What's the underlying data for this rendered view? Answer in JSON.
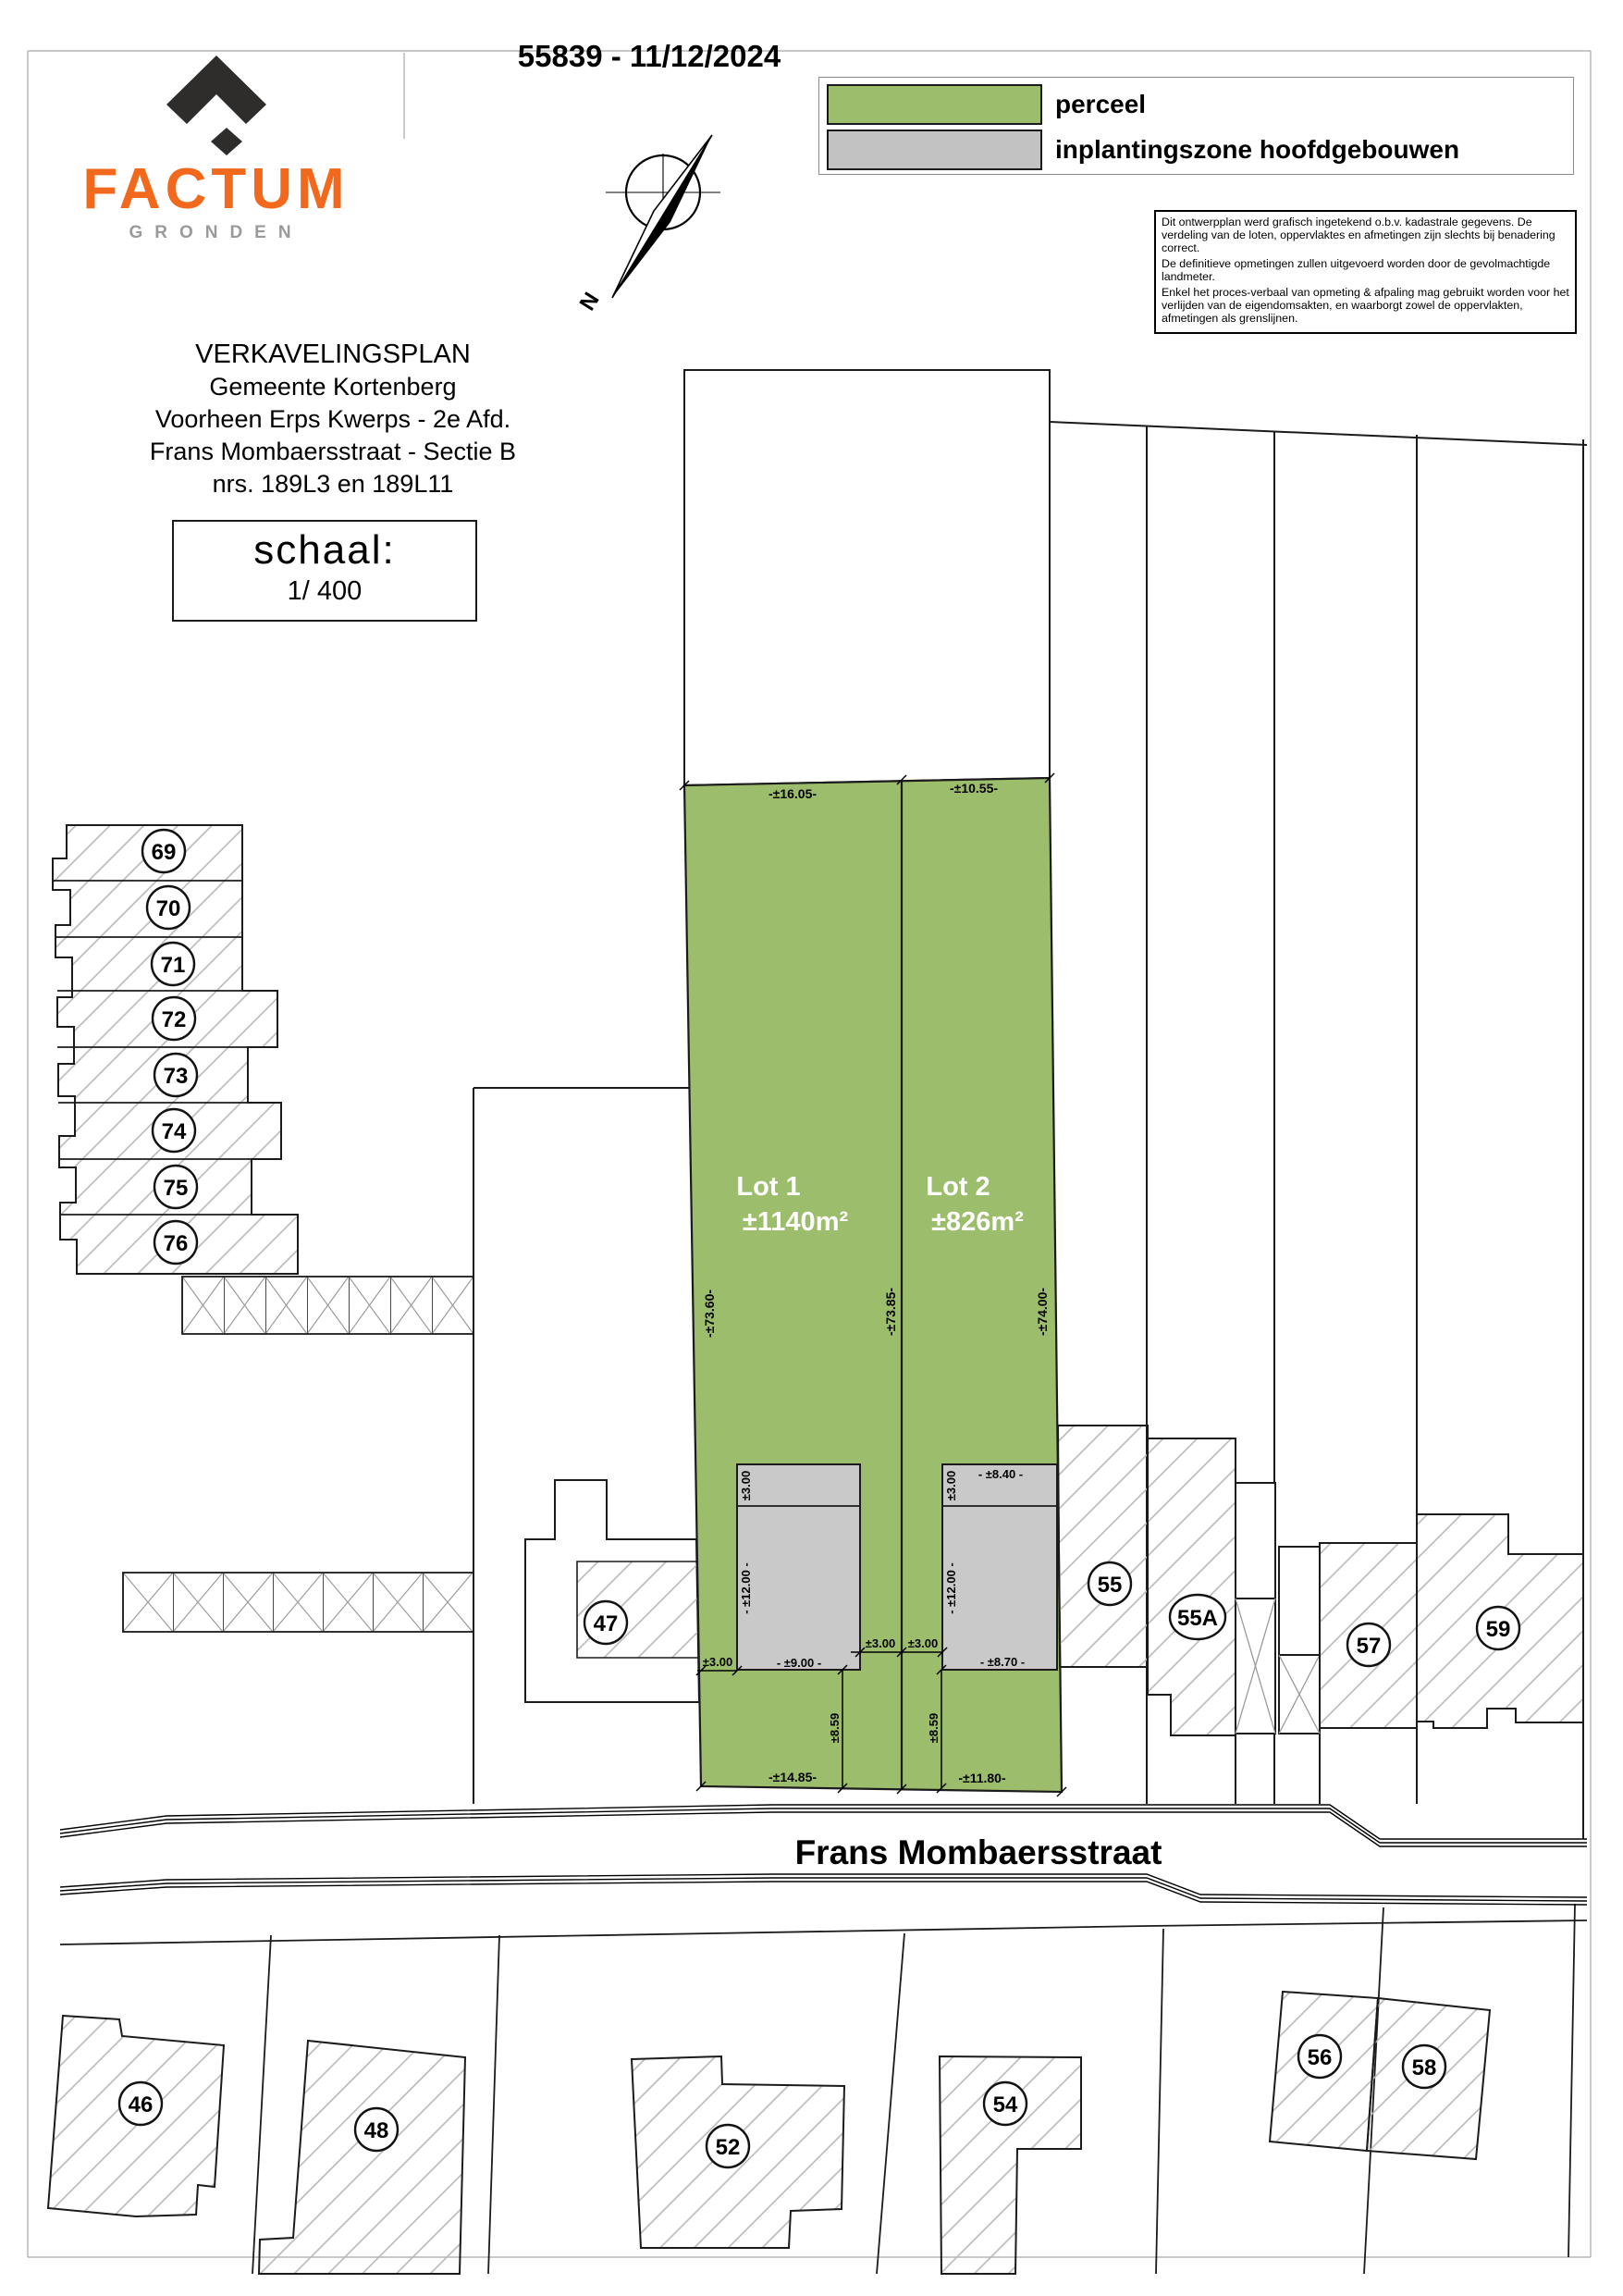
{
  "header": {
    "plan_number": "55839 - 11/12/2024",
    "logo": {
      "brand": "FACTUM",
      "subtitle": "GRONDEN",
      "brand_color": "#F2691D",
      "icon_color": "#2E2D2C",
      "subtitle_color": "#9A9A9A"
    },
    "compass": {
      "label": "N"
    },
    "legend": {
      "perceel": {
        "label": "perceel",
        "color": "#9CBE6C"
      },
      "inplanting": {
        "label": "inplantingszone hoofdgebouwen",
        "color": "#C2C2C2"
      }
    },
    "disclaimer": {
      "p1": "Dit ontwerpplan werd grafisch ingetekend o.b.v. kadastrale gegevens. De verdeling van de loten, oppervlaktes en afmetingen zijn slechts bij benadering correct.",
      "p2": "De definitieve opmetingen zullen uitgevoerd worden door de gevolmachtigde landmeter.",
      "p3": "Enkel het proces-verbaal van opmeting & afpaling mag gebruikt worden voor het verlijden van de eigendomsakten, en waarborgt zowel de oppervlakten, afmetingen als grenslijnen."
    }
  },
  "title_block": {
    "line1": "VERKAVELINGSPLAN",
    "line2": "Gemeente Kortenberg",
    "line3": "Voorheen Erps Kwerps - 2e Afd.",
    "line4": "Frans Mombaersstraat - Sectie B",
    "line5": "nrs. 189L3 en 189L11",
    "scale_label": "schaal:",
    "scale_value": "1/ 400"
  },
  "plan": {
    "street_name": "Frans Mombaersstraat",
    "lot1": {
      "name": "Lot 1",
      "area": "±1140m²"
    },
    "lot2": {
      "name": "Lot 2",
      "area": "±826m²"
    },
    "dims": {
      "lot1_width_top": "-±16.05-",
      "lot2_width_top": "-±10.55-",
      "lot1_depth_left": "-±73.60-",
      "depth_middle": "-±73.85-",
      "lot2_depth_right": "-±74.00-",
      "bz1_front_strip": "±3.00",
      "bz1_depth": "- ±12.00 -",
      "bz1_width": "- ±9.00 -",
      "bz1_offset_left": "±3.00",
      "bz1_offset_right": "±3.00",
      "bz2_offset_left": "±3.00",
      "bz2_width_top": "- ±8.40 -",
      "bz2_front_strip": "±3.00",
      "bz2_depth": "- ±12.00 -",
      "bz2_width_bottom": "- ±8.70 -",
      "setback_lot1": "±8.59",
      "setback_lot2": "±8.59",
      "lot1_width_bottom": "-±14.85-",
      "lot2_width_bottom": "-±11.80-"
    },
    "parcels": {
      "69": "69",
      "70": "70",
      "71": "71",
      "72": "72",
      "73": "73",
      "74": "74",
      "75": "75",
      "76": "76",
      "47": "47",
      "55": "55",
      "55A": "55A",
      "57": "57",
      "59": "59",
      "46": "46",
      "48": "48",
      "52": "52",
      "54": "54",
      "56": "56",
      "58": "58"
    }
  }
}
